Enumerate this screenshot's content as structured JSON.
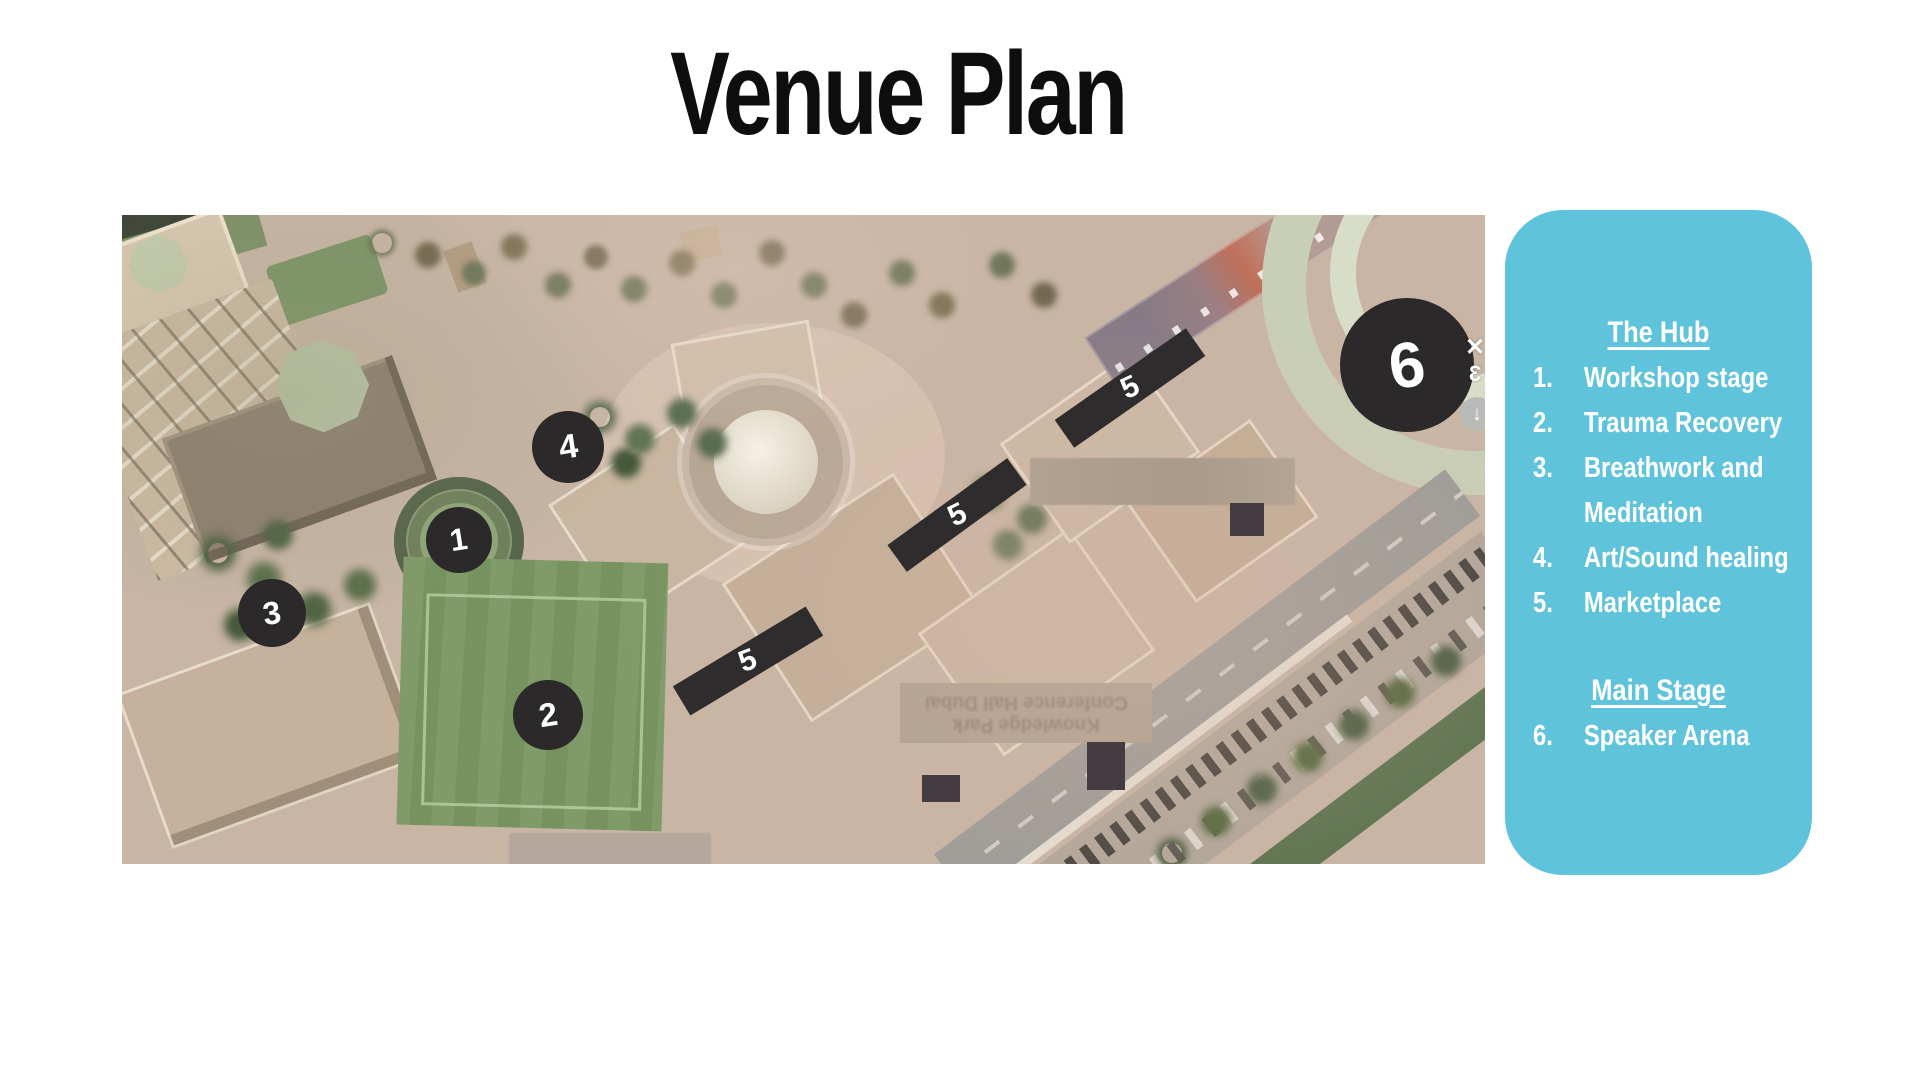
{
  "page": {
    "title": "Venue Plan"
  },
  "map": {
    "markers": [
      {
        "id": "1",
        "label": "1",
        "x": 337,
        "y": 325,
        "r": 33
      },
      {
        "id": "2",
        "label": "2",
        "x": 426,
        "y": 500,
        "r": 35
      },
      {
        "id": "3",
        "label": "3",
        "x": 150,
        "y": 398,
        "r": 34
      },
      {
        "id": "4",
        "label": "4",
        "x": 446,
        "y": 232,
        "r": 36
      },
      {
        "id": "6",
        "label": "6",
        "x": 1285,
        "y": 150,
        "r": 67
      }
    ],
    "zone_bars": [
      {
        "label": "5",
        "x": 626,
        "y": 446,
        "len": 155,
        "th": 34,
        "angle": -31
      },
      {
        "label": "5",
        "x": 835,
        "y": 300,
        "len": 148,
        "th": 33,
        "angle": -36
      },
      {
        "label": "5",
        "x": 1008,
        "y": 173,
        "len": 160,
        "th": 34,
        "angle": -35
      }
    ],
    "obscured_label": {
      "line1": "Conference Hall Dubai",
      "line2": "Knowledge Park"
    },
    "edge_icons": [
      {
        "name": "x-glyph",
        "char": "✕"
      },
      {
        "name": "mirrored-3-glyph",
        "char": "3"
      },
      {
        "name": "download-arrow-icon",
        "char": "↓"
      }
    ],
    "colors": {
      "marker_bg": "#2b292a",
      "bar_bg": "#2e2c2d",
      "marker_text": "#ffffff"
    }
  },
  "legend": {
    "colors": {
      "background": "#5fc3dc",
      "text": "#ffffff"
    },
    "sections": [
      {
        "heading": "The Hub",
        "items": [
          {
            "num": "1.",
            "label": "Workshop stage"
          },
          {
            "num": "2.",
            "label": "Trauma Recovery"
          },
          {
            "num": "3.",
            "label": "Breathwork and Meditation"
          },
          {
            "num": "4.",
            "label": "Art/Sound healing"
          },
          {
            "num": "5.",
            "label": "Marketplace"
          }
        ]
      },
      {
        "heading": "Main Stage",
        "items": [
          {
            "num": "6.",
            "label": "Speaker Arena"
          }
        ]
      }
    ]
  }
}
